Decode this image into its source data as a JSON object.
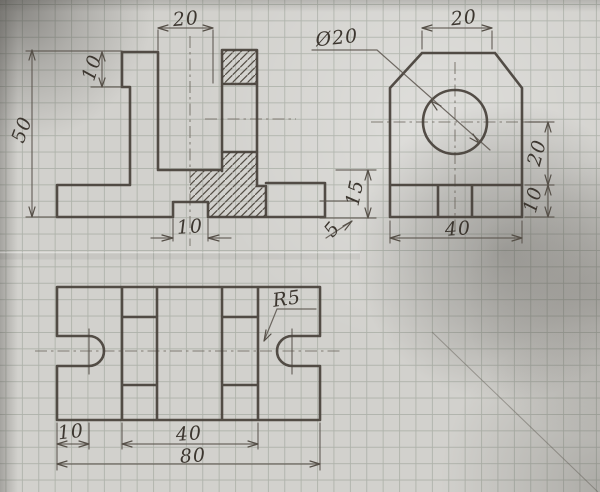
{
  "page": {
    "kind": "hand-drawn three-view engineering sketch on graph paper"
  },
  "colors": {
    "paper": "#d2d1cd",
    "grid_line": "#7a8476",
    "pencil_thick": "#46403a",
    "pencil_thin": "#5a544c",
    "handwriting": "#3c362f"
  },
  "dims": {
    "front_slot_width": "20",
    "front_head_height": "10",
    "front_total_height": "50",
    "front_notch_width": "10",
    "gap_floor_height": "15",
    "gap_notch_depth": "5",
    "side_hole_diameter": "Ø20",
    "side_top_width": "20",
    "side_axis_to_base": "20",
    "side_base_height": "10",
    "side_width": "40",
    "top_slot_offset": "10",
    "top_span": "40",
    "top_length": "80",
    "top_notch_radius": "R5"
  }
}
